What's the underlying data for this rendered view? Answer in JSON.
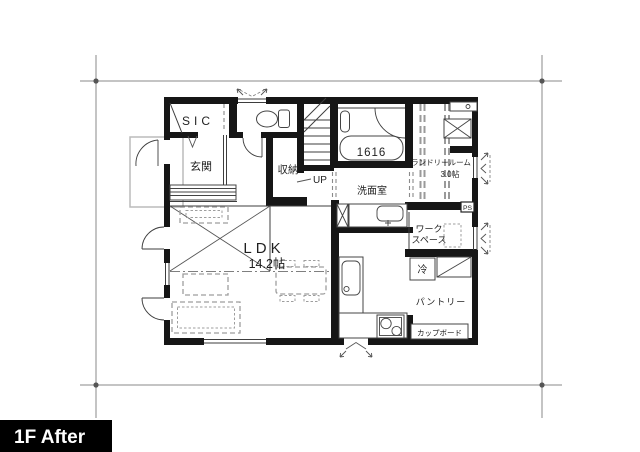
{
  "badge": {
    "label": "1F After"
  },
  "colors": {
    "wall": "#161616",
    "line": "#3d3d3d",
    "furniture": "#9e9e9e",
    "dimension": "#8a8a8a",
    "badge_bg": "#000000",
    "badge_fg": "#ffffff"
  },
  "rooms": {
    "sic": {
      "label": "SIC"
    },
    "genkan": {
      "label": "玄関"
    },
    "shuno": {
      "label": "収納"
    },
    "stairs": {
      "up": "UP"
    },
    "bath": {
      "tub_size": "1616"
    },
    "senmen": {
      "label": "洗面室"
    },
    "laundry": {
      "name": "ランドリールーム",
      "size": "3.0帖"
    },
    "ps": {
      "label": "PS"
    },
    "workspace": {
      "line1": "ワーク",
      "line2": "スペース"
    },
    "ldk": {
      "label": "LDK",
      "size": "14.2帖"
    },
    "pantry": {
      "label": "パントリー"
    },
    "fridge": {
      "label": "冷"
    },
    "cupboard": {
      "label": "カップボード"
    }
  }
}
